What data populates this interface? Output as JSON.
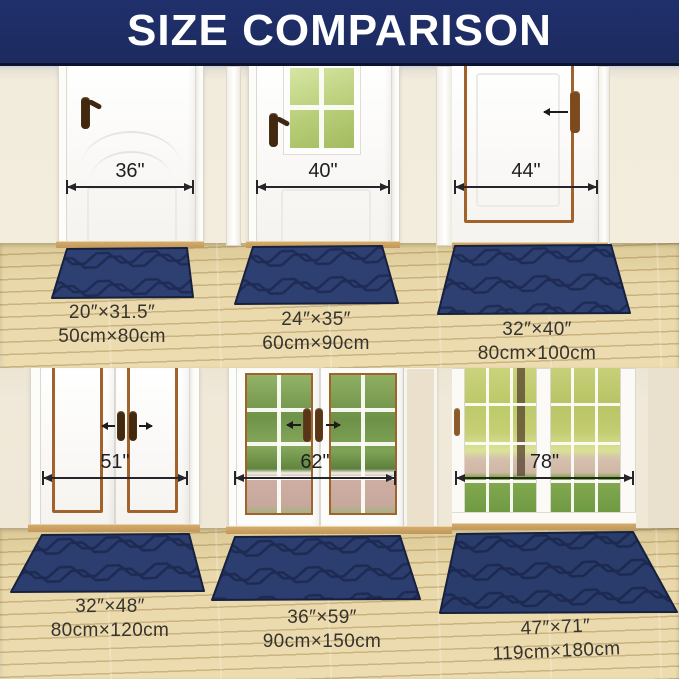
{
  "header": {
    "title": "SIZE COMPARISON"
  },
  "colors": {
    "header_bg": "#1c2a5e",
    "wall": "#f2ecdd",
    "floor_wood": "#e9d8aa",
    "mat_navy": "#2e4072",
    "mat_groove": "#1e2c55",
    "copper_trim": "#a2622c",
    "measure_text": "#1f1f22"
  },
  "scenes": [
    {
      "door_style": "single-panel-door",
      "door_width": "36\"",
      "mat_inches": "20″×31.5″",
      "mat_cm": "50cm×80cm"
    },
    {
      "door_style": "door-with-window",
      "door_width": "40\"",
      "mat_inches": "24″×35″",
      "mat_cm": "60cm×90cm"
    },
    {
      "door_style": "copper-trim-door",
      "door_width": "44\"",
      "mat_inches": "32″×40″",
      "mat_cm": "80cm×100cm"
    },
    {
      "door_style": "double-panel-doors",
      "door_width": "51\"",
      "mat_inches": "32″×48″",
      "mat_cm": "80cm×120cm"
    },
    {
      "door_style": "french-doors",
      "door_width": "62\"",
      "mat_inches": "36″×59″",
      "mat_cm": "90cm×150cm"
    },
    {
      "door_style": "glass-patio-doors",
      "door_width": "78\"",
      "mat_inches": "47″×71″",
      "mat_cm": "119cm×180cm"
    }
  ]
}
